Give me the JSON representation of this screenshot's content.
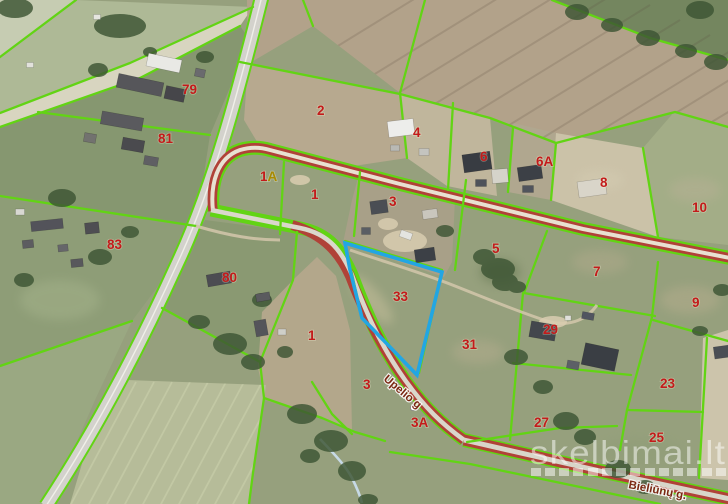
{
  "map": {
    "watermark": {
      "text": "skelbimai.lt"
    },
    "streets": [
      {
        "name": "Upelio g"
      },
      {
        "name": "Bieliūnų g."
      }
    ],
    "parcels": [
      {
        "label": "79"
      },
      {
        "label": "81"
      },
      {
        "label": "83"
      },
      {
        "label": "80"
      },
      {
        "label": "2"
      },
      {
        "label": "4"
      },
      {
        "label": "6"
      },
      {
        "label": "6A"
      },
      {
        "label": "8"
      },
      {
        "label": "10"
      },
      {
        "label": "1A",
        "num": "1",
        "suffix": "A"
      },
      {
        "label": "1"
      },
      {
        "label": "3"
      },
      {
        "label": "5"
      },
      {
        "label": "7"
      },
      {
        "label": "9"
      },
      {
        "label": "33"
      },
      {
        "label": "31"
      },
      {
        "label": "29"
      },
      {
        "label": "23"
      },
      {
        "label": "27"
      },
      {
        "label": "25"
      },
      {
        "label": "1"
      },
      {
        "label": "3"
      },
      {
        "label": "3A"
      }
    ],
    "highlighted_parcel": "33",
    "colors": {
      "boundary": "#62d414",
      "route": "#b04238",
      "highlight": "#22a6e3",
      "label": "#c31b1b",
      "street_label": "#7b2813"
    }
  }
}
